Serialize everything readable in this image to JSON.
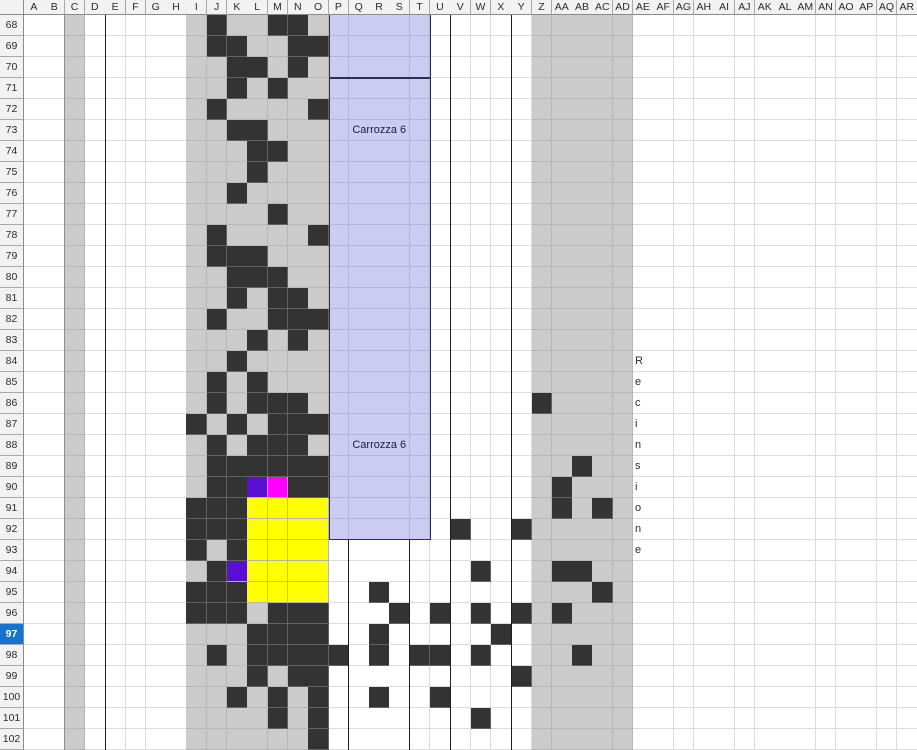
{
  "sheet": {
    "columns": [
      "A",
      "B",
      "C",
      "D",
      "E",
      "F",
      "G",
      "H",
      "I",
      "J",
      "K",
      "L",
      "M",
      "N",
      "O",
      "P",
      "Q",
      "R",
      "S",
      "T",
      "U",
      "V",
      "W",
      "X",
      "Y",
      "Z",
      "AA",
      "AB",
      "AC",
      "AD",
      "AE",
      "AF",
      "AG",
      "AH",
      "AI",
      "AJ",
      "AK",
      "AL",
      "AM",
      "AN",
      "AO",
      "AP",
      "AQ",
      "AR"
    ],
    "rows": [
      68,
      69,
      70,
      71,
      72,
      73,
      74,
      75,
      76,
      77,
      78,
      79,
      80,
      81,
      82,
      83,
      84,
      85,
      86,
      87,
      88,
      89,
      90,
      91,
      92,
      93,
      94,
      95,
      96,
      97,
      98,
      99,
      100,
      101,
      102
    ],
    "selected_row": 97,
    "gray_columns": [
      "C",
      "I",
      "J",
      "K",
      "L",
      "M",
      "N",
      "O",
      "Z",
      "AA",
      "AB",
      "AC",
      "AD"
    ],
    "column_separators": [
      {
        "column": "C",
        "tone": "gray",
        "from_row": 68
      },
      {
        "column": "E",
        "tone": "black",
        "from_row": 68
      },
      {
        "column": "Q",
        "tone": "black",
        "from_row": 93
      },
      {
        "column": "T",
        "tone": "black",
        "from_row": 93
      },
      {
        "column": "V",
        "tone": "black",
        "from_row": 68
      },
      {
        "column": "Y",
        "tone": "black",
        "from_row": 68
      }
    ],
    "cells": {
      "dark": [
        "J68",
        "M68",
        "N68",
        "J69",
        "K69",
        "N69",
        "O69",
        "K70",
        "L70",
        "N70",
        "K71",
        "M71",
        "J72",
        "O72",
        "K73",
        "L73",
        "L74",
        "M74",
        "L75",
        "K76",
        "M77",
        "J78",
        "O78",
        "J79",
        "K79",
        "L79",
        "K80",
        "L80",
        "M80",
        "K81",
        "M81",
        "N81",
        "J82",
        "M82",
        "N82",
        "O82",
        "L83",
        "N83",
        "K84",
        "J85",
        "L85",
        "J86",
        "L86",
        "M86",
        "N86",
        "Z86",
        "I87",
        "K87",
        "M87",
        "N87",
        "O87",
        "J88",
        "L88",
        "M88",
        "N88",
        "J89",
        "K89",
        "L89",
        "M89",
        "N89",
        "O89",
        "AB89",
        "J90",
        "K90",
        "N90",
        "O90",
        "AA90",
        "I91",
        "J91",
        "K91",
        "AA91",
        "AC91",
        "I92",
        "J92",
        "K92",
        "V92",
        "Y92",
        "I93",
        "K93",
        "J94",
        "W94",
        "AA94",
        "AB94",
        "I95",
        "J95",
        "K95",
        "R95",
        "AC95",
        "I96",
        "J96",
        "K96",
        "M96",
        "N96",
        "O96",
        "S96",
        "U96",
        "W96",
        "Y96",
        "AA96",
        "L97",
        "M97",
        "N97",
        "O97",
        "R97",
        "X97",
        "J98",
        "L98",
        "M98",
        "N98",
        "O98",
        "P98",
        "R98",
        "T98",
        "U98",
        "W98",
        "AB98",
        "L99",
        "N99",
        "O99",
        "Y99",
        "K100",
        "M100",
        "O100",
        "R100",
        "U100",
        "M101",
        "O101",
        "W101",
        "O102"
      ],
      "yellow": [
        "L91",
        "M91",
        "N91",
        "O91",
        "L92",
        "M92",
        "N92",
        "O92",
        "L93",
        "M93",
        "N93",
        "O93",
        "L94",
        "M94",
        "N94",
        "O94",
        "L95",
        "M95",
        "N95",
        "O95"
      ],
      "violet": [
        "L90",
        "K94"
      ],
      "magenta": [
        "M90"
      ]
    }
  },
  "overlays": {
    "boxes": [
      {
        "name": "carriage-shape-top",
        "col_start": "P",
        "col_end": "T",
        "row_start": 68,
        "row_end": 70,
        "open_top": true,
        "labels": []
      },
      {
        "name": "carriage-shape-main",
        "col_start": "P",
        "col_end": "T",
        "row_start": 71,
        "row_end": 92,
        "open_top": false,
        "labels": [
          {
            "text": "Carrozza 6",
            "row": 73
          },
          {
            "text": "Carrozza 6",
            "row": 88
          }
        ]
      }
    ],
    "vertical_text": {
      "word": "Recinsione",
      "column": "AE",
      "letters": [
        {
          "row": 84,
          "char": "R"
        },
        {
          "row": 85,
          "char": "e"
        },
        {
          "row": 86,
          "char": "c"
        },
        {
          "row": 87,
          "char": "i"
        },
        {
          "row": 88,
          "char": "n"
        },
        {
          "row": 89,
          "char": "s"
        },
        {
          "row": 90,
          "char": "i"
        },
        {
          "row": 91,
          "char": "o"
        },
        {
          "row": 92,
          "char": "n"
        },
        {
          "row": 93,
          "char": "e"
        }
      ]
    }
  },
  "colors": {
    "cell_dark": "#333333",
    "cell_yellow": "#ffff00",
    "cell_violet": "#5a0ed2",
    "cell_magenta": "#ff00ff",
    "band_gray": "#cbcbcb",
    "carriage_fill": "#ccccf3",
    "carriage_border": "#2e2e55",
    "selected_header_bg": "#1674d0",
    "selected_header_text": "#ffffff",
    "header_bg": "#f2f2f2",
    "header_text": "#2b2b2b",
    "separator_black": "#1e1e1e",
    "separator_gray": "#8f8f8f"
  }
}
